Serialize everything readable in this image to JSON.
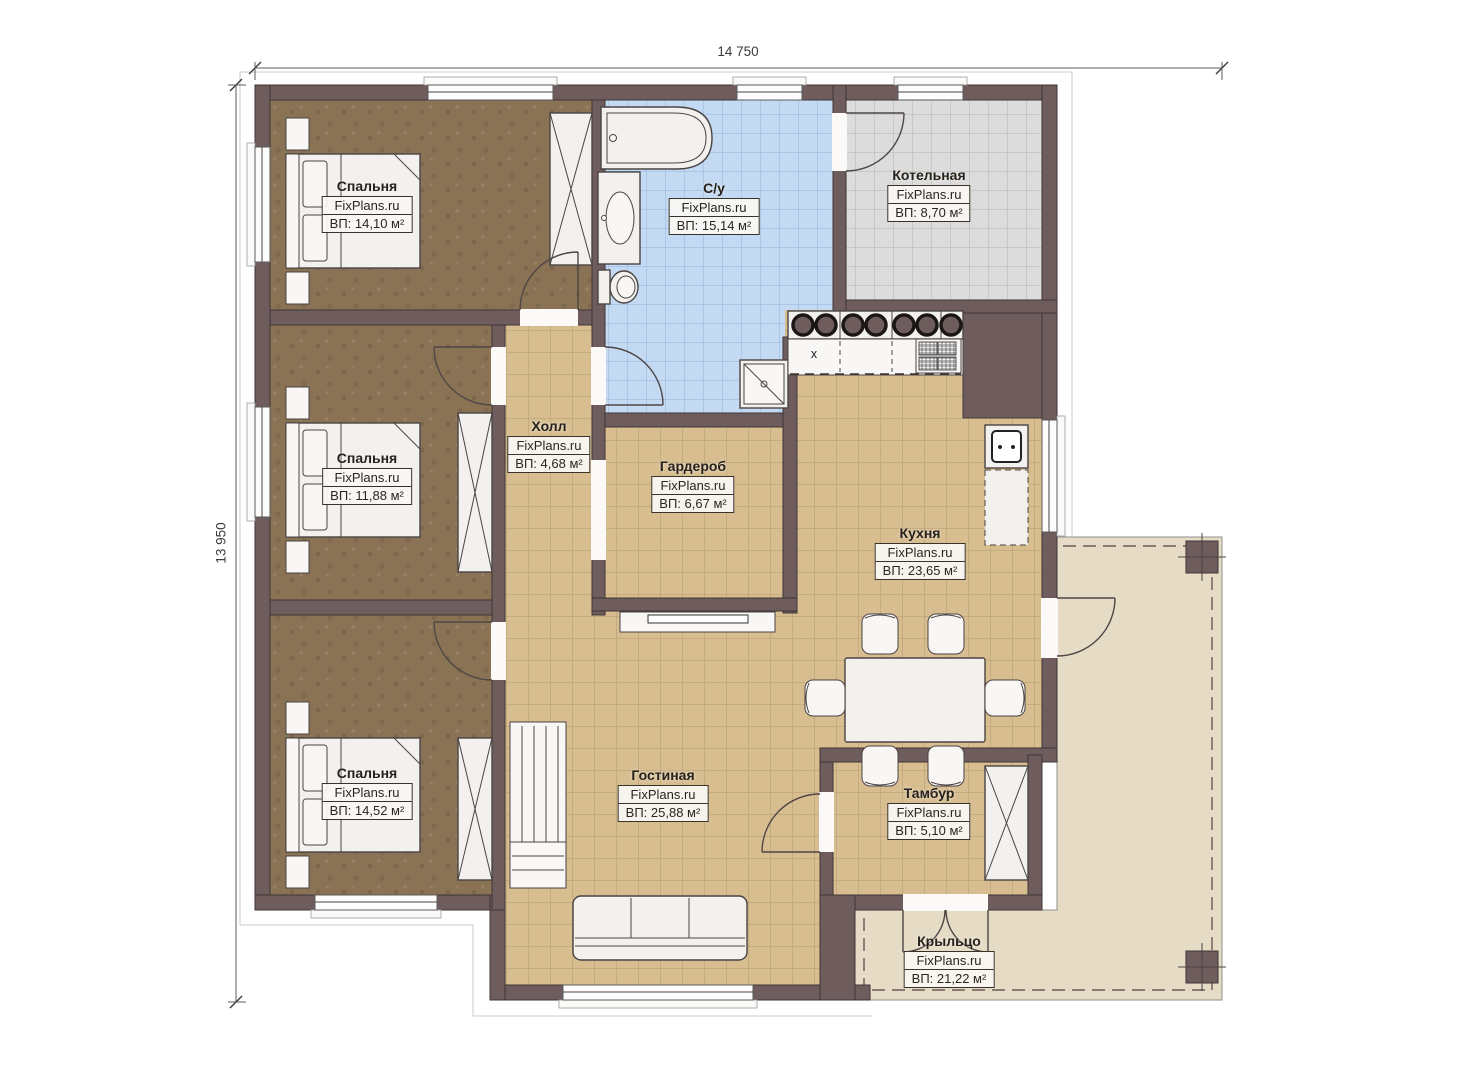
{
  "dimensions": {
    "width": "14 750",
    "height": "13 950"
  },
  "rooms": [
    {
      "id": "bedroom-1",
      "name": "Спальня",
      "watermark": "FixPlans.ru",
      "area": "ВП: 14,10 м²"
    },
    {
      "id": "bathroom",
      "name": "С/у",
      "watermark": "FixPlans.ru",
      "area": "ВП: 15,14 м²"
    },
    {
      "id": "boiler-room",
      "name": "Котельная",
      "watermark": "FixPlans.ru",
      "area": "ВП: 8,70 м²"
    },
    {
      "id": "hall",
      "name": "Холл",
      "watermark": "FixPlans.ru",
      "area": "ВП: 4,68 м²"
    },
    {
      "id": "wardrobe",
      "name": "Гардероб",
      "watermark": "FixPlans.ru",
      "area": "ВП: 6,67 м²"
    },
    {
      "id": "bedroom-2",
      "name": "Спальня",
      "watermark": "FixPlans.ru",
      "area": "ВП: 11,88 м²"
    },
    {
      "id": "kitchen",
      "name": "Кухня",
      "watermark": "FixPlans.ru",
      "area": "ВП: 23,65 м²"
    },
    {
      "id": "bedroom-3",
      "name": "Спальня",
      "watermark": "FixPlans.ru",
      "area": "ВП: 14,52 м²"
    },
    {
      "id": "living-room",
      "name": "Гостиная",
      "watermark": "FixPlans.ru",
      "area": "ВП: 25,88 м²"
    },
    {
      "id": "vestibule",
      "name": "Тамбур",
      "watermark": "FixPlans.ru",
      "area": "ВП: 5,10 м²"
    },
    {
      "id": "porch",
      "name": "Крыльцо",
      "watermark": "FixPlans.ru",
      "area": "ВП: 21,22 м²"
    }
  ],
  "kitchen": {
    "sink_mark": "х"
  },
  "colors": {
    "wall": "#6f5d5d",
    "bedroom_floor": "#8a7355",
    "tile_tan": "#d7bd90",
    "tile_blue": "#c3daf2",
    "tile_gray": "#dcdcdc",
    "porch_floor": "#e6dcc6"
  }
}
